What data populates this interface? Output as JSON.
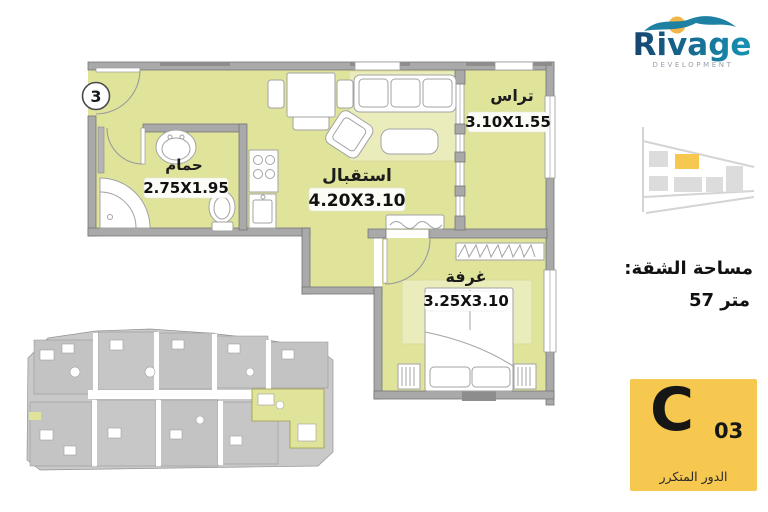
{
  "colors": {
    "floor": "#e0e49b",
    "rug": "#eaecbc",
    "wall": "#a9a9a9",
    "wall_dark": "#8d8d8d",
    "wall_stroke": "#767676",
    "furniture_stroke": "#a3a3a3",
    "accent_yellow": "#f6c84f",
    "logo_blue_dark": "#16456f",
    "logo_blue_light": "#1693b4",
    "logo_teal": "#1e81a4",
    "logo_sun": "#f2b648",
    "tagline_gray": "#97a1aa",
    "site_gray": "#c9c9c9",
    "map_line": "#d4d4d4",
    "map_block": "#dcdcdc"
  },
  "logo": {
    "brand": "Rivage",
    "tagline": "DEVELOPMENT"
  },
  "plan": {
    "unit_marker": "3",
    "rooms": {
      "bathroom": {
        "name": "حمام",
        "dims": "2.75X1.95"
      },
      "reception": {
        "name": "استقبال",
        "dims": "4.20X3.10"
      },
      "terrace": {
        "name": "تراس",
        "dims": "3.10X1.55"
      },
      "bedroom": {
        "name": "غرفة",
        "dims": "3.25X3.10"
      }
    }
  },
  "area": {
    "label": "مساحة الشقة:",
    "value": "57 متر"
  },
  "badge": {
    "letter": "C",
    "number": "03",
    "floor_label": "الدور المتكرر"
  }
}
